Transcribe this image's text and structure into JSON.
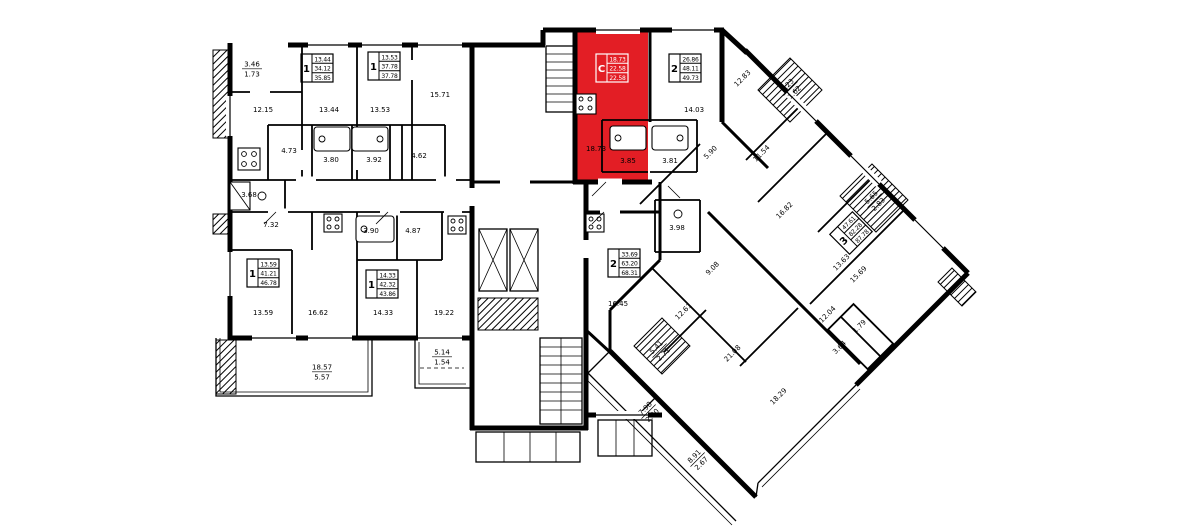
{
  "plan": {
    "background": "#ffffff",
    "wall_color": "#000000",
    "highlight_color": "#e31e25",
    "highlighted_apartment": {
      "type_label": "С",
      "living_area": "18.73",
      "area": "22.58",
      "total_area": "22.58"
    },
    "apartment_stamps": [
      {
        "id": "apt-1a",
        "digit": "1",
        "values": [
          "13.44",
          "34.12",
          "35.85"
        ],
        "x": 317,
        "y": 68,
        "rot": 0,
        "style": "normal"
      },
      {
        "id": "apt-1b",
        "digit": "1",
        "values": [
          "13.53",
          "37.78",
          "37.78"
        ],
        "x": 384,
        "y": 66,
        "rot": 0,
        "style": "normal"
      },
      {
        "id": "apt-studio",
        "digit": "С",
        "values": [
          "18.73",
          "22.58",
          "22.58"
        ],
        "x": 612,
        "y": 68,
        "rot": 0,
        "style": "highlight"
      },
      {
        "id": "apt-2a",
        "digit": "2",
        "values": [
          "26.86",
          "48.11",
          "49.73"
        ],
        "x": 685,
        "y": 68,
        "rot": 0,
        "style": "normal"
      },
      {
        "id": "apt-1c",
        "digit": "1",
        "values": [
          "13.59",
          "41.21",
          "46.78"
        ],
        "x": 263,
        "y": 273,
        "rot": 0,
        "style": "normal"
      },
      {
        "id": "apt-1d",
        "digit": "1",
        "values": [
          "14.33",
          "42.32",
          "43.86"
        ],
        "x": 382,
        "y": 284,
        "rot": 0,
        "style": "normal"
      },
      {
        "id": "apt-2b",
        "digit": "2",
        "values": [
          "33.69",
          "63.20",
          "68.31"
        ],
        "x": 624,
        "y": 263,
        "rot": 0,
        "style": "normal"
      },
      {
        "id": "apt-3",
        "digit": "3",
        "values": [
          "47.61",
          "82.28",
          "87.78"
        ],
        "x": 851,
        "y": 233,
        "rot": -45,
        "style": "normal"
      }
    ],
    "room_labels": [
      {
        "text": "3.46",
        "sub": "1.73",
        "x": 252,
        "y": 68
      },
      {
        "text": "12.15",
        "x": 263,
        "y": 112
      },
      {
        "text": "13.44",
        "x": 329,
        "y": 112
      },
      {
        "text": "13.53",
        "x": 380,
        "y": 112
      },
      {
        "text": "15.71",
        "x": 440,
        "y": 97
      },
      {
        "text": "4.73",
        "x": 289,
        "y": 153
      },
      {
        "text": "3.80",
        "x": 331,
        "y": 162
      },
      {
        "text": "3.92",
        "x": 374,
        "y": 162
      },
      {
        "text": "4.62",
        "x": 419,
        "y": 158
      },
      {
        "text": "3.68",
        "x": 249,
        "y": 197
      },
      {
        "text": "7.32",
        "x": 271,
        "y": 227
      },
      {
        "text": "3.90",
        "x": 371,
        "y": 233
      },
      {
        "text": "4.87",
        "x": 413,
        "y": 233
      },
      {
        "text": "13.59",
        "x": 263,
        "y": 315
      },
      {
        "text": "16.62",
        "x": 318,
        "y": 315
      },
      {
        "text": "14.33",
        "x": 383,
        "y": 315
      },
      {
        "text": "19.22",
        "x": 444,
        "y": 315
      },
      {
        "text": "18.57",
        "sub": "5.57",
        "x": 322,
        "y": 371
      },
      {
        "text": "5.14",
        "sub": "1.54",
        "x": 442,
        "y": 356
      },
      {
        "text": "18.73",
        "x": 596,
        "y": 151
      },
      {
        "text": "3.85",
        "x": 628,
        "y": 163
      },
      {
        "text": "3.81",
        "x": 670,
        "y": 163
      },
      {
        "text": "14.03",
        "x": 694,
        "y": 112
      },
      {
        "text": "16.45",
        "x": 618,
        "y": 306
      },
      {
        "text": "3.98",
        "x": 677,
        "y": 230
      },
      {
        "text": "12.83",
        "x": 744,
        "y": 80,
        "r": -45
      },
      {
        "text": "3.23",
        "sub": "1.62",
        "x": 790,
        "y": 88,
        "r": -45
      },
      {
        "text": "5.90",
        "x": 712,
        "y": 154,
        "r": -45
      },
      {
        "text": "11.54",
        "x": 763,
        "y": 155,
        "r": -45
      },
      {
        "text": "16.82",
        "x": 786,
        "y": 212,
        "r": -45
      },
      {
        "text": "5.65",
        "sub": "2.83",
        "x": 874,
        "y": 200,
        "r": -45
      },
      {
        "text": "13.63",
        "x": 843,
        "y": 264,
        "r": -45
      },
      {
        "text": "15.69",
        "x": 860,
        "y": 276,
        "r": -45
      },
      {
        "text": "12.04",
        "x": 829,
        "y": 316,
        "r": -45
      },
      {
        "text": "1.79",
        "x": 861,
        "y": 328,
        "r": -45
      },
      {
        "text": "3.64",
        "x": 841,
        "y": 349,
        "r": -45
      },
      {
        "text": "18.29",
        "x": 780,
        "y": 398,
        "r": -45
      },
      {
        "text": "9.08",
        "x": 714,
        "y": 270,
        "r": -45
      },
      {
        "text": "12.61",
        "x": 685,
        "y": 313,
        "r": -45
      },
      {
        "text": "21.08",
        "x": 734,
        "y": 355,
        "r": -45
      },
      {
        "text": "5.41",
        "sub": "2.71",
        "x": 659,
        "y": 350,
        "r": -45
      },
      {
        "text": "7.98",
        "sub": "2.40",
        "x": 648,
        "y": 411,
        "r": -45
      },
      {
        "text": "8.91",
        "sub": "2.67",
        "x": 697,
        "y": 459,
        "r": -45
      }
    ]
  }
}
